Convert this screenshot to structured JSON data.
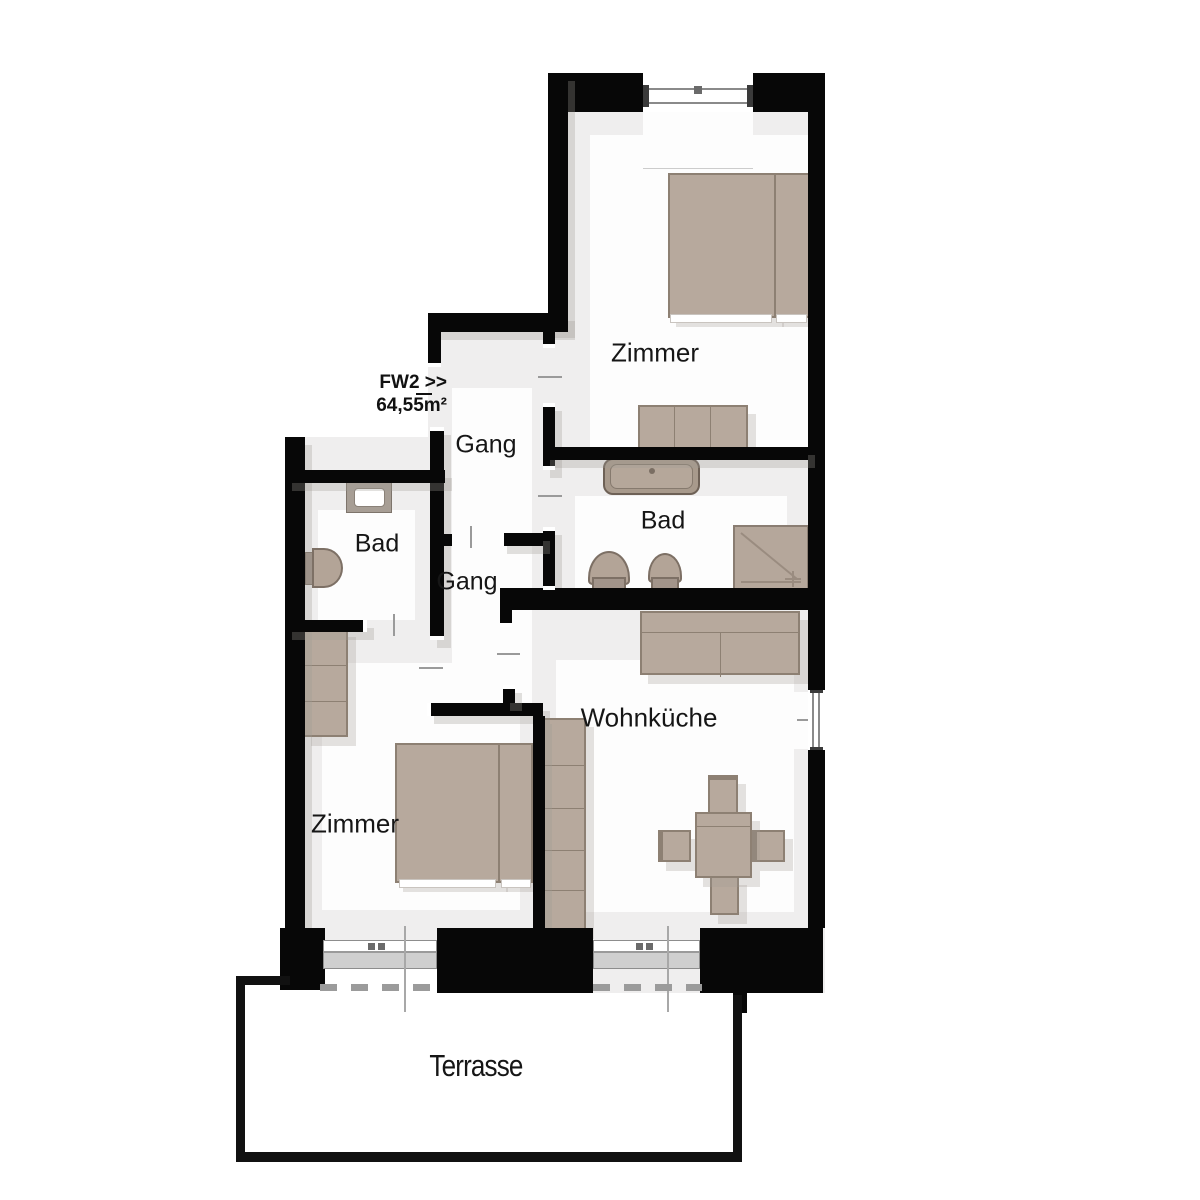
{
  "plan": {
    "unit": {
      "code_label": "FW2 >>",
      "area_label": "64,55m²"
    },
    "labels": {
      "zimmer_top": "Zimmer",
      "bad_right": "Bad",
      "gang_upper": "Gang",
      "gang_lower": "Gang",
      "bad_left": "Bad",
      "wohnkueche": "Wohnküche",
      "zimmer_bottom": "Zimmer",
      "terrasse": "Terrasse"
    },
    "colors": {
      "wall": "#070707",
      "floor": "#efeeee",
      "room": "#fdfdfd",
      "furniture": "#b7a99d",
      "furniture_border": "#8d8073",
      "fixture": "#b3a497",
      "window_sill": "#cfcfcf",
      "opening_marker": "#9a9a9a",
      "text": "#161616"
    }
  }
}
